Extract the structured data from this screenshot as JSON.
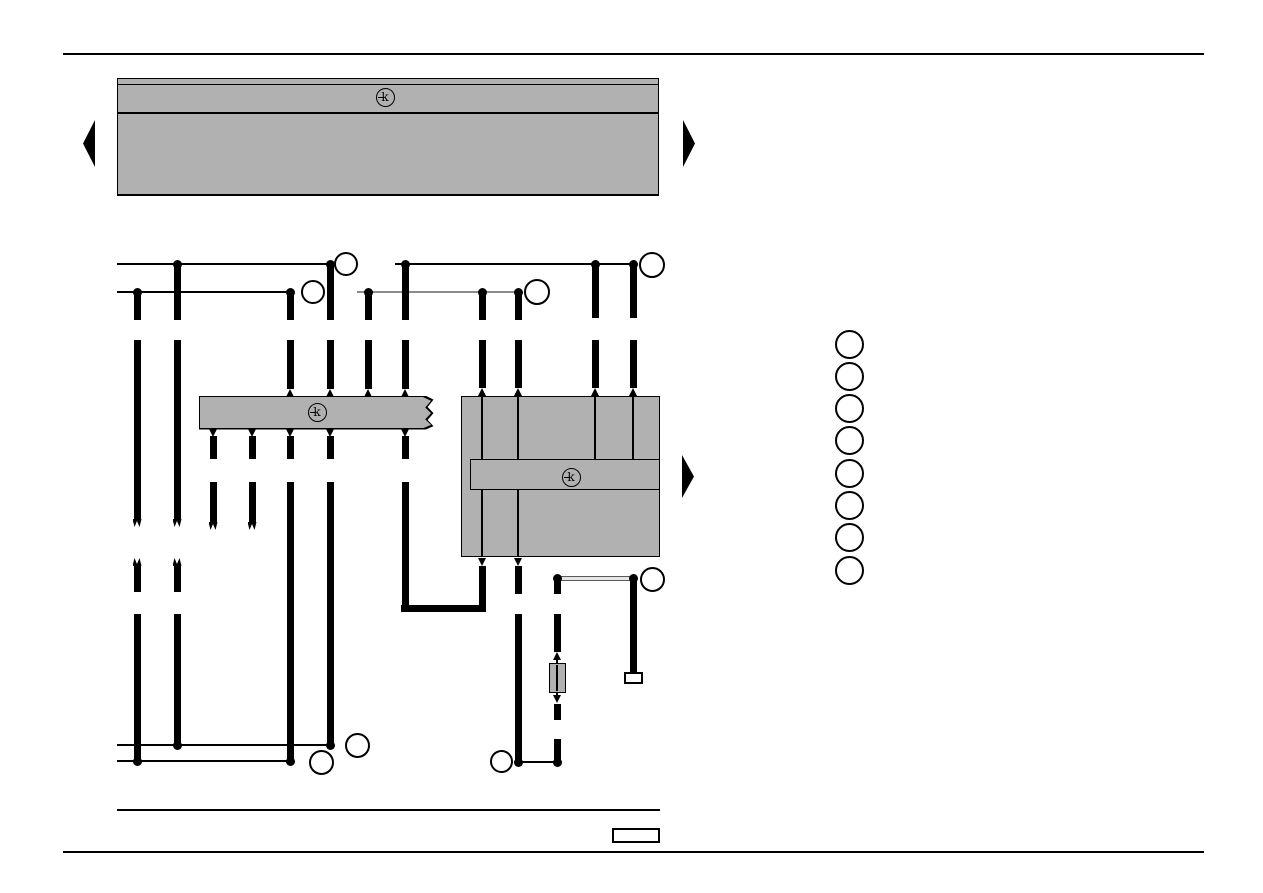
{
  "page": {
    "width": 1263,
    "height": 893,
    "background": "#ffffff"
  },
  "colors": {
    "ink": "#000000",
    "panel_fill": "#b1b1b1",
    "gray_wire": "#8c8c8c",
    "shield_edge": "#5a5a5a",
    "shield_core": "#e6e6e6",
    "white": "#ffffff"
  },
  "symbols": {
    "component_key": "k"
  },
  "rules": [
    {
      "name": "page-top-rule",
      "x": 63,
      "y": 53,
      "w": 1141,
      "h": 2
    },
    {
      "name": "page-bottom-rule",
      "x": 63,
      "y": 851,
      "w": 1141,
      "h": 2
    },
    {
      "name": "diagram-bottom-rule",
      "x": 117,
      "y": 809,
      "w": 543,
      "h": 2
    }
  ],
  "top_panel": {
    "x": 117,
    "y": 78,
    "w": 542,
    "h": 118,
    "header_line_y": 84,
    "divider_y": 112,
    "k_cx": 385,
    "k_cy": 97
  },
  "mid_strip": {
    "x": 200,
    "y": 397,
    "w": 231,
    "h": 31,
    "k_cx": 317,
    "k_cy": 412,
    "torn_right": true
  },
  "module_box": {
    "x": 461,
    "y": 396,
    "w": 199,
    "h": 161,
    "inner_x": 470,
    "inner_y": 459,
    "inner_w": 190,
    "inner_h": 31,
    "k_cx": 571,
    "k_cy": 477
  },
  "nav_arrows": [
    {
      "name": "prev-page-arrow",
      "dir": "left",
      "x": 83,
      "y": 120,
      "w": 12,
      "h": 47
    },
    {
      "name": "next-page-arrow",
      "dir": "right",
      "x": 683,
      "y": 120,
      "w": 12,
      "h": 47
    },
    {
      "name": "module-continues-arrow",
      "dir": "right",
      "x": 682,
      "y": 455,
      "w": 12,
      "h": 43
    }
  ],
  "hlines": [
    {
      "name": "bus-line-left-1",
      "x1": 117,
      "x2": 330,
      "y": 264,
      "t": 1.6,
      "c": "ink"
    },
    {
      "name": "bus-line-left-2",
      "x1": 117,
      "x2": 290,
      "y": 292,
      "t": 1.6,
      "c": "ink"
    },
    {
      "name": "bus-line-right-1",
      "x1": 395,
      "x2": 633,
      "y": 264,
      "t": 1.6,
      "c": "ink"
    },
    {
      "name": "bus-line-right-2",
      "x1": 357,
      "x2": 518,
      "y": 292,
      "t": 2,
      "c": "gray_wire"
    },
    {
      "name": "bottom-line-1",
      "x1": 117,
      "x2": 330,
      "y": 745,
      "t": 1.6,
      "c": "ink"
    },
    {
      "name": "bottom-line-2",
      "x1": 117,
      "x2": 290,
      "y": 761,
      "t": 1.6,
      "c": "ink"
    },
    {
      "name": "bottom-link-line",
      "x1": 518,
      "x2": 557,
      "y": 762,
      "t": 1.6,
      "c": "ink"
    },
    {
      "name": "u-turn-bottom",
      "x1": 401,
      "x2": 486,
      "y": 608,
      "t": 7,
      "c": "ink"
    }
  ],
  "shield_line": {
    "name": "shielded-pair-line",
    "x1": 557,
    "x2": 633,
    "y": 578,
    "h": 5
  },
  "wires": [
    {
      "x": 137,
      "segs": [
        [
          292,
          320
        ],
        [
          340,
          519
        ],
        [
          566,
          592
        ],
        [
          614,
          761
        ]
      ]
    },
    {
      "x": 177,
      "segs": [
        [
          264,
          320
        ],
        [
          340,
          519
        ],
        [
          566,
          592
        ],
        [
          614,
          745
        ]
      ]
    },
    {
      "x": 213,
      "segs": [
        [
          436,
          459
        ],
        [
          482,
          522
        ]
      ]
    },
    {
      "x": 252,
      "segs": [
        [
          436,
          459
        ],
        [
          482,
          522
        ]
      ]
    },
    {
      "x": 290,
      "segs": [
        [
          292,
          320
        ],
        [
          340,
          389
        ],
        [
          436,
          459
        ],
        [
          482,
          761
        ]
      ]
    },
    {
      "x": 330,
      "segs": [
        [
          264,
          320
        ],
        [
          340,
          389
        ],
        [
          436,
          459
        ],
        [
          482,
          745
        ]
      ]
    },
    {
      "x": 368,
      "segs": [
        [
          292,
          320
        ],
        [
          340,
          389
        ]
      ]
    },
    {
      "x": 405,
      "segs": [
        [
          264,
          320
        ],
        [
          340,
          389
        ],
        [
          436,
          459
        ],
        [
          482,
          612
        ]
      ]
    },
    {
      "x": 482,
      "segs": [
        [
          292,
          320
        ],
        [
          340,
          388
        ],
        [
          566,
          612
        ]
      ]
    },
    {
      "x": 518,
      "segs": [
        [
          292,
          320
        ],
        [
          340,
          388
        ],
        [
          566,
          594
        ],
        [
          614,
          762
        ]
      ]
    },
    {
      "x": 557,
      "segs": [
        [
          578,
          594
        ],
        [
          614,
          652
        ],
        [
          704,
          720
        ],
        [
          739,
          762
        ]
      ]
    },
    {
      "x": 595,
      "segs": [
        [
          264,
          318
        ],
        [
          340,
          388
        ]
      ]
    },
    {
      "x": 633,
      "segs": [
        [
          264,
          318
        ],
        [
          340,
          388
        ],
        [
          578,
          672
        ]
      ]
    }
  ],
  "thin_wires": [
    {
      "x": 482,
      "y1": 397,
      "y2": 459
    },
    {
      "x": 518,
      "y1": 397,
      "y2": 459
    },
    {
      "x": 595,
      "y1": 397,
      "y2": 459
    },
    {
      "x": 633,
      "y1": 397,
      "y2": 459
    },
    {
      "x": 482,
      "y1": 490,
      "y2": 557
    },
    {
      "x": 518,
      "y1": 490,
      "y2": 557
    },
    {
      "x": 557,
      "y1": 654,
      "y2": 700
    }
  ],
  "dots": [
    [
      177,
      264
    ],
    [
      330,
      264
    ],
    [
      405,
      264
    ],
    [
      595,
      264
    ],
    [
      633,
      264
    ],
    [
      137,
      292
    ],
    [
      290,
      292
    ],
    [
      368,
      292
    ],
    [
      482,
      292
    ],
    [
      518,
      292
    ],
    [
      557,
      578
    ],
    [
      633,
      578
    ],
    [
      177,
      745
    ],
    [
      330,
      745
    ],
    [
      137,
      761
    ],
    [
      290,
      761
    ],
    [
      518,
      762
    ],
    [
      557,
      762
    ]
  ],
  "small_arrows": [
    {
      "x": 290,
      "y": 389,
      "d": "up"
    },
    {
      "x": 330,
      "y": 389,
      "d": "up"
    },
    {
      "x": 368,
      "y": 389,
      "d": "up"
    },
    {
      "x": 405,
      "y": 389,
      "d": "up"
    },
    {
      "x": 482,
      "y": 388,
      "d": "up"
    },
    {
      "x": 518,
      "y": 388,
      "d": "up"
    },
    {
      "x": 595,
      "y": 388,
      "d": "up"
    },
    {
      "x": 633,
      "y": 388,
      "d": "up"
    },
    {
      "x": 213,
      "y": 429,
      "d": "down"
    },
    {
      "x": 252,
      "y": 429,
      "d": "down"
    },
    {
      "x": 290,
      "y": 429,
      "d": "down"
    },
    {
      "x": 330,
      "y": 429,
      "d": "down"
    },
    {
      "x": 405,
      "y": 429,
      "d": "down"
    },
    {
      "x": 482,
      "y": 558,
      "d": "down"
    },
    {
      "x": 518,
      "y": 558,
      "d": "down"
    },
    {
      "x": 557,
      "y": 652,
      "d": "up"
    },
    {
      "x": 557,
      "y": 695,
      "d": "down"
    }
  ],
  "forks": [
    {
      "x": 137,
      "y": 519,
      "d": "down"
    },
    {
      "x": 137,
      "y": 558,
      "d": "up"
    },
    {
      "x": 177,
      "y": 519,
      "d": "down"
    },
    {
      "x": 177,
      "y": 558,
      "d": "up"
    },
    {
      "x": 213,
      "y": 522,
      "d": "down"
    },
    {
      "x": 252,
      "y": 522,
      "d": "down"
    }
  ],
  "label_circles": [
    {
      "name": "wire-label-circle",
      "cx": 346,
      "cy": 264,
      "r": 12
    },
    {
      "name": "wire-label-circle",
      "cx": 313,
      "cy": 292,
      "r": 12
    },
    {
      "name": "wire-label-circle",
      "cx": 537,
      "cy": 292,
      "r": 13
    },
    {
      "name": "wire-label-circle",
      "cx": 652,
      "cy": 265,
      "r": 13
    },
    {
      "name": "wire-label-circle",
      "cx": 652,
      "cy": 579,
      "r": 12.5
    },
    {
      "name": "wire-label-circle",
      "cx": 357,
      "cy": 745,
      "r": 12.5
    },
    {
      "name": "wire-label-circle",
      "cx": 321,
      "cy": 762,
      "r": 12.5
    },
    {
      "name": "wire-label-circle",
      "cx": 501,
      "cy": 761,
      "r": 11.5
    }
  ],
  "legend_circles": {
    "cx": 849,
    "start_cy": 344,
    "step": 32.3,
    "count": 8,
    "r": 14.5
  },
  "fuse": {
    "x": 549,
    "y": 663,
    "w": 17,
    "h": 30
  },
  "terminator": {
    "x": 624,
    "y": 672,
    "w": 19,
    "h": 12
  },
  "page_label_box": {
    "x": 612,
    "y": 828,
    "w": 48,
    "h": 15
  }
}
